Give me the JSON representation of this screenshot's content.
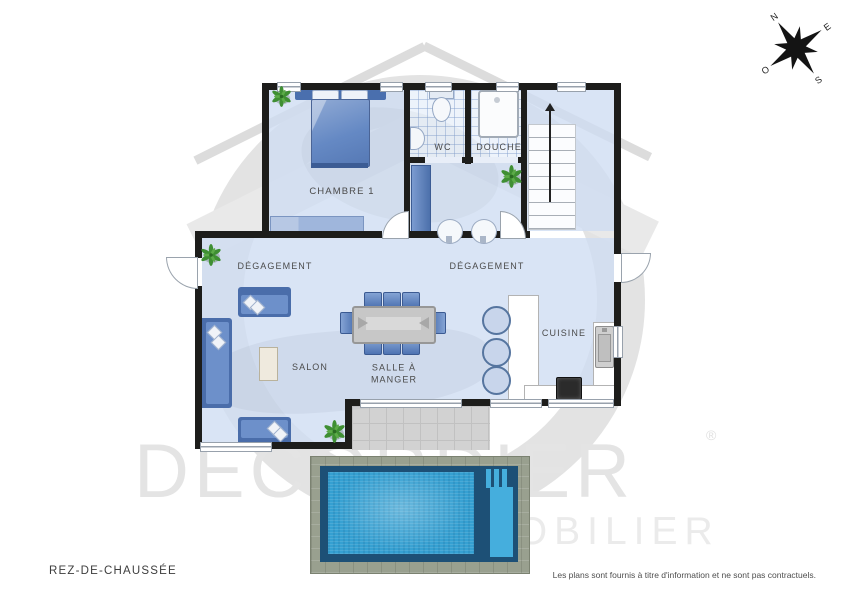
{
  "plan": {
    "floor_label": "REZ-DE-CHAUSSÉE",
    "disclaimer": "Les plans sont fournis à titre d'information et ne sont pas contractuels.",
    "rooms": {
      "chambre1": "CHAMBRE 1",
      "wc": "WC",
      "douche": "DOUCHE",
      "degagement_left": "DÉGAGEMENT",
      "degagement_right": "DÉGAGEMENT",
      "salon": "SALON",
      "salle_a_manger": {
        "line1": "SALLE À",
        "line2": "MANGER"
      },
      "cuisine": "CUISINE"
    }
  },
  "watermark": {
    "brand": "DECORDIER",
    "registered": "®",
    "subtitle": "IMMOBILIER"
  },
  "compass": {
    "north": "N",
    "east": "E",
    "south": "S",
    "west": "O"
  },
  "colors": {
    "wall": "#1d1d1b",
    "floor": "#d7e1f2",
    "furniture_blue": "#5b84c6",
    "pool_water": "#35a0d2",
    "pool_stone": "#99a08f",
    "watermark_gray": "#e4e4e4",
    "label_text": "#4b4b4b"
  }
}
